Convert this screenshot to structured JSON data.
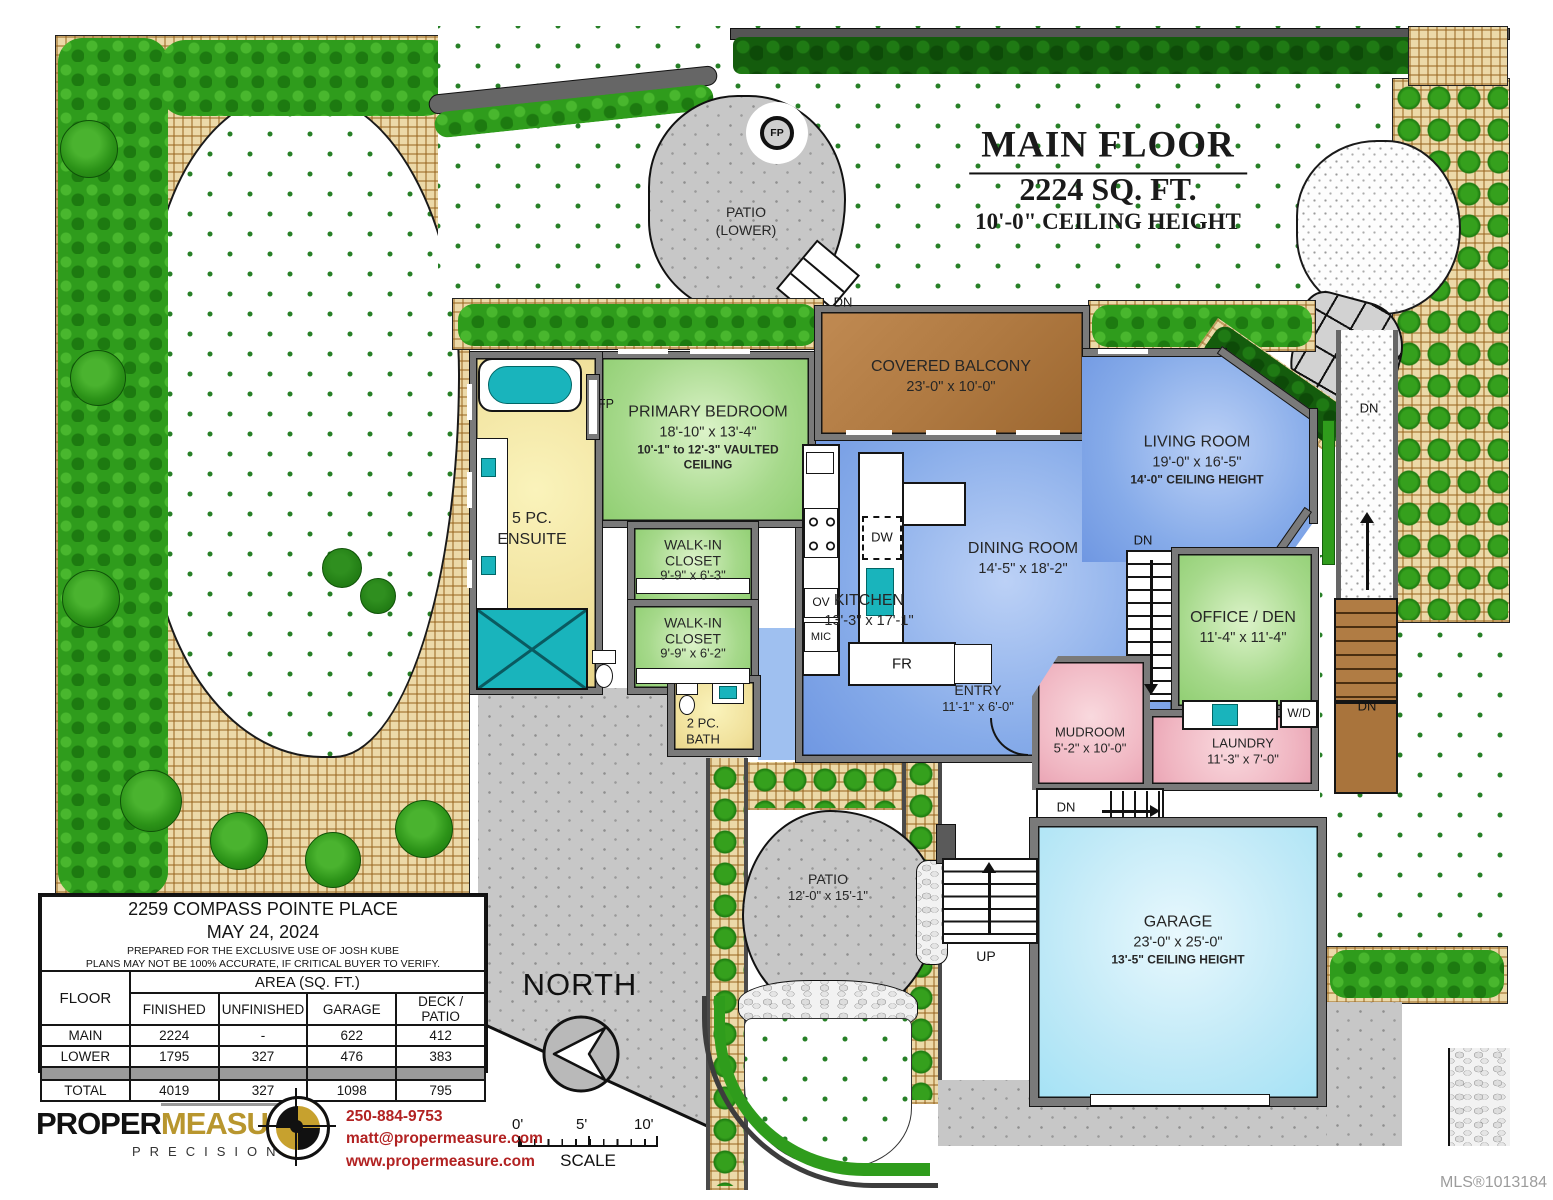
{
  "header": {
    "title_line1": "MAIN FLOOR",
    "title_line2": "2224 SQ. FT.",
    "title_line3": "10'-0\" CEILING HEIGHT"
  },
  "rooms": {
    "patio_lower": {
      "name": "PATIO",
      "dims": "(LOWER)"
    },
    "covered_balcony": {
      "name": "COVERED BALCONY",
      "dims": "23'-0\" x 10'-0\""
    },
    "primary_bedroom": {
      "name": "PRIMARY BEDROOM",
      "dims": "18'-10\" x 13'-4\"",
      "note": "10'-1\" to 12'-3\" VAULTED",
      "note2": "CEILING"
    },
    "ensuite": {
      "name": "5 PC.",
      "dims": "ENSUITE"
    },
    "walk_in_closet_1": {
      "name": "WALK-IN",
      "dims": "CLOSET",
      "note": "9'-9\" x 6'-3\""
    },
    "walk_in_closet_2": {
      "name": "WALK-IN",
      "dims": "CLOSET",
      "note": "9'-9\" x 6'-2\""
    },
    "bath": {
      "name": "2 PC.",
      "dims": "BATH"
    },
    "kitchen": {
      "name": "KITCHEN",
      "dims": "13'-3\" x 17'-1\""
    },
    "dining_room": {
      "name": "DINING ROOM",
      "dims": "14'-5\" x 18'-2\""
    },
    "living_room": {
      "name": "LIVING ROOM",
      "dims": "19'-0\" x 16'-5\"",
      "note": "14'-0\" CEILING HEIGHT"
    },
    "office_den": {
      "name": "OFFICE / DEN",
      "dims": "11'-4\" x 11'-4\""
    },
    "entry": {
      "name": "ENTRY",
      "dims": "11'-1\" x 6'-0\""
    },
    "mudroom": {
      "name": "MUDROOM",
      "dims": "5'-2\" x 10'-0\""
    },
    "laundry": {
      "name": "LAUNDRY",
      "dims": "11'-3\" x 7'-0\""
    },
    "garage": {
      "name": "GARAGE",
      "dims": "23'-0\" x 25'-0\"",
      "note": "13'-5\" CEILING HEIGHT"
    },
    "patio": {
      "name": "PATIO",
      "dims": "12'-0\" x 15'-1\""
    }
  },
  "markers": {
    "fp": "FP",
    "dn": "DN",
    "up": "UP",
    "dw": "DW",
    "ov": "OV",
    "mic": "MIC",
    "fr": "FR",
    "wd": "W/D"
  },
  "compass": {
    "north": "NORTH"
  },
  "scale_bar": {
    "tick0": "0'",
    "tick5": "5'",
    "tick10": "10'",
    "label": "SCALE"
  },
  "info_table": {
    "address": "2259 COMPASS POINTE PLACE",
    "date": "MAY 24, 2024",
    "note1": "PREPARED FOR THE EXCLUSIVE USE OF JOSH KUBE",
    "note2": "PLANS MAY NOT BE 100% ACCURATE, IF CRITICAL BUYER TO VERIFY.",
    "floor_header": "FLOOR",
    "area_header": "AREA (SQ. FT.)",
    "columns": [
      "FINISHED",
      "UNFINISHED",
      "GARAGE",
      "DECK / PATIO"
    ],
    "rows": [
      {
        "label": "MAIN",
        "values": [
          "2224",
          "-",
          "622",
          "412"
        ]
      },
      {
        "label": "LOWER",
        "values": [
          "1795",
          "327",
          "476",
          "383"
        ]
      }
    ],
    "total": {
      "label": "TOTAL",
      "values": [
        "4019",
        "327",
        "1098",
        "795"
      ]
    }
  },
  "logo": {
    "word1": "PROPER",
    "word2": "MEASURE",
    "tm": "TM",
    "tagline": "PRECISION"
  },
  "contact": {
    "phone": "250-884-9753",
    "email": "matt@propermeasure.com",
    "website": "www.propermeasure.com"
  },
  "footer": {
    "mls": "MLS®1013184"
  },
  "colors": {
    "room_blue": "#86abe9",
    "room_green": "#a6d98b",
    "room_yellow": "#f0e09a",
    "room_pink": "#f0b6c2",
    "garage_cyan": "#bfe9f7",
    "balcony_brown": "#b07a42",
    "wall_gray": "#7a7a7a",
    "fixture_teal": "#19b4bc",
    "hedge_green": "#2f9c1c",
    "mulch_tan": "#ecd9a8",
    "contact_red": "#b22222",
    "logo_gold": "#b8962e"
  }
}
